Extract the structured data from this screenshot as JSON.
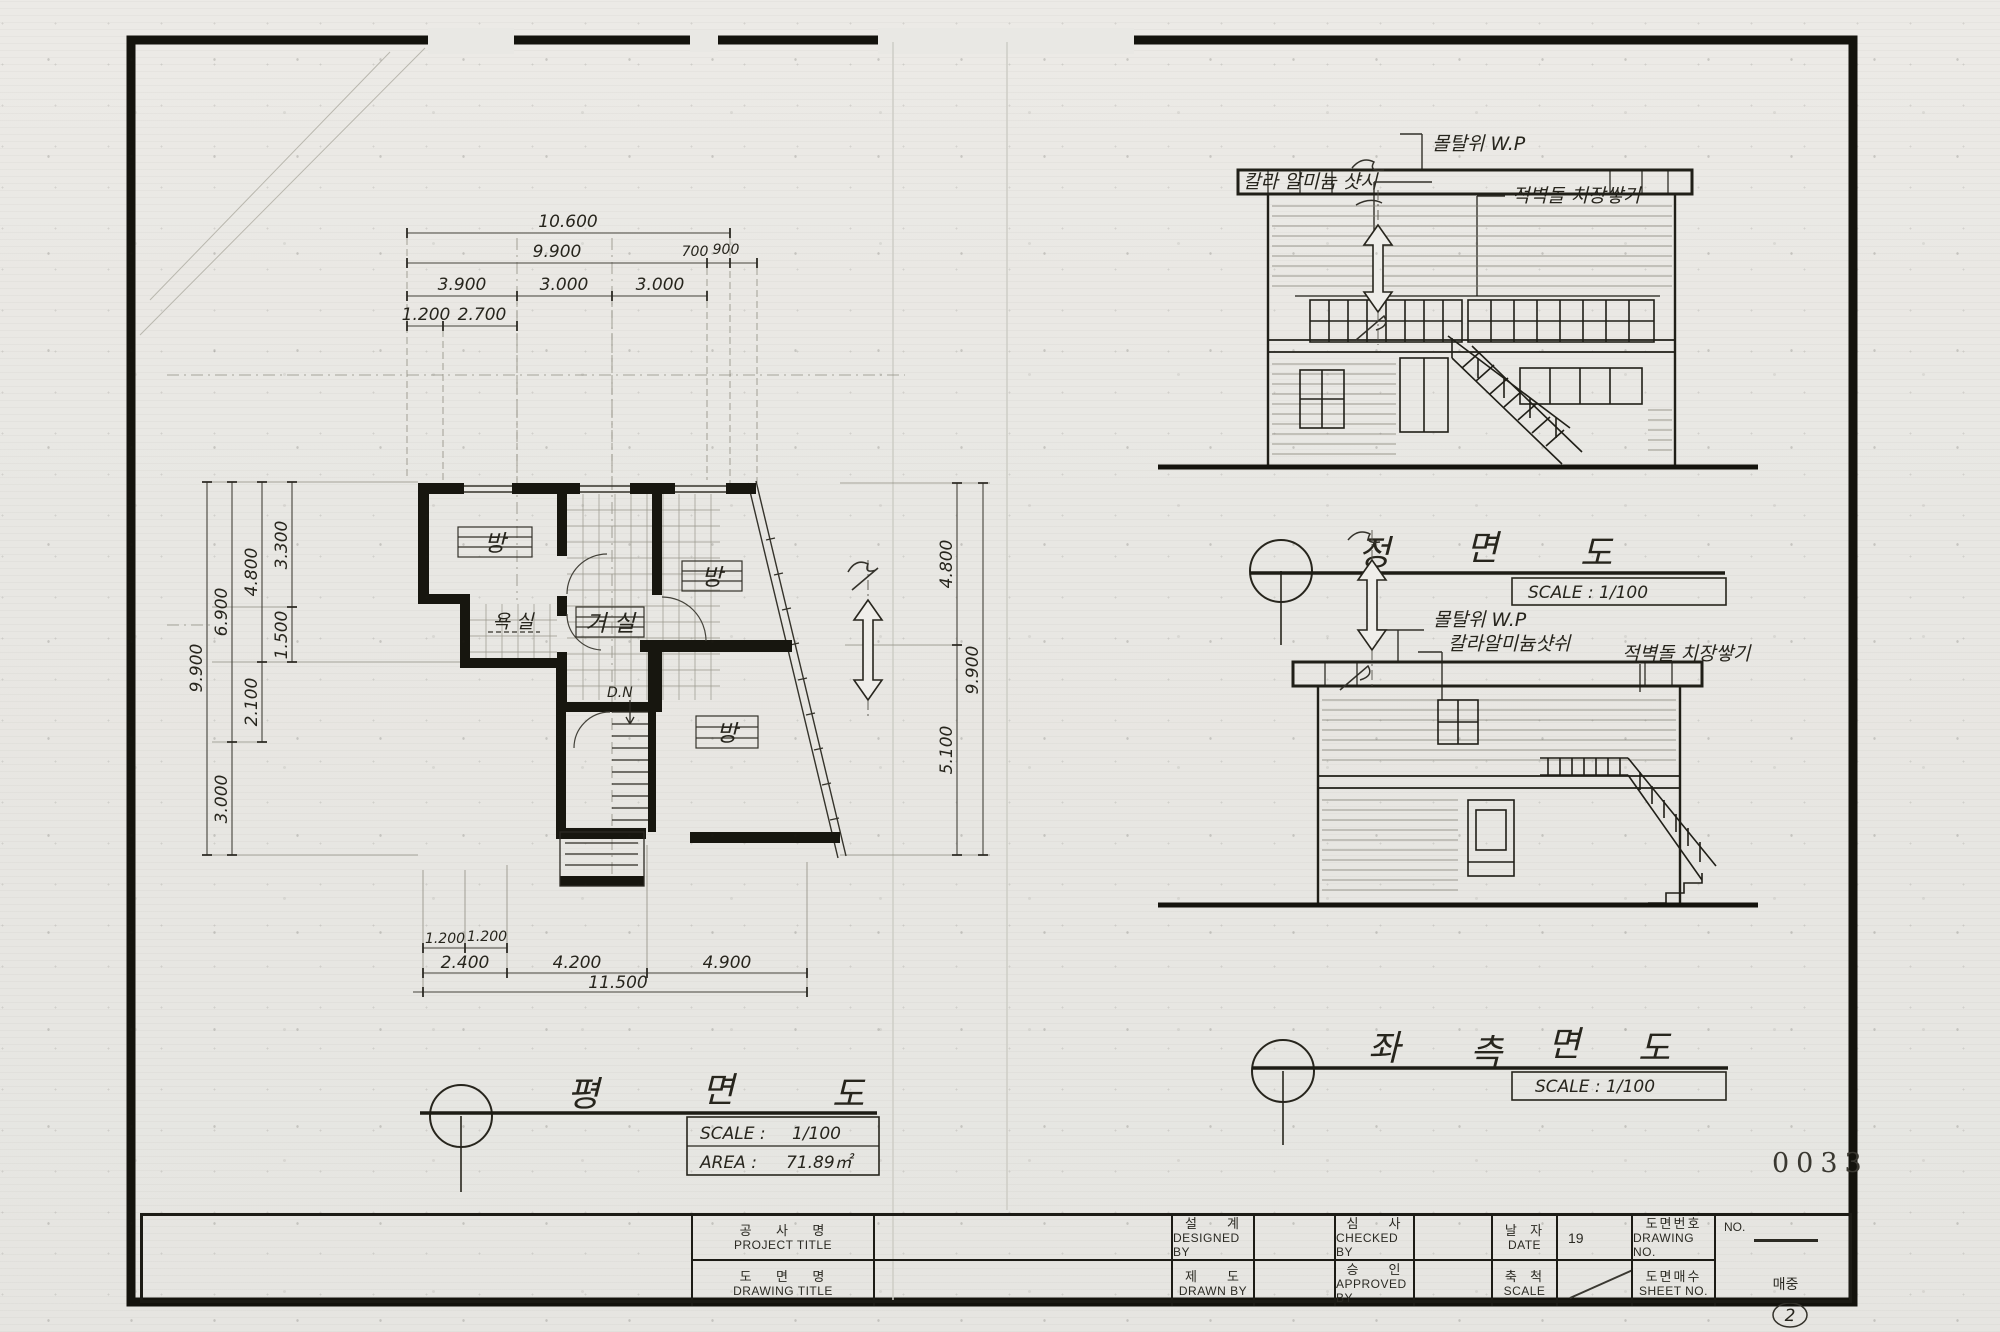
{
  "colors": {
    "paper": "#e8e7e3",
    "ink": "#201f18",
    "ink_light": "#55534a"
  },
  "stamp_number": "0033",
  "page_corner_note": "2",
  "floor_plan": {
    "title_chars": [
      "평",
      "면",
      "도"
    ],
    "scale_label": "SCALE :",
    "scale_value": "1/100",
    "area_label": "AREA :",
    "area_value": "71.89㎡",
    "rooms": {
      "room_top_left": "방",
      "room_right": "방",
      "room_bottom": "방",
      "living": "거  실",
      "bath": "욕 실",
      "stair": "D.N"
    },
    "dims_top": [
      "10.600",
      "9.900",
      "700",
      "900",
      "3.900",
      "3.000",
      "3.000",
      "1.200",
      "2.700"
    ],
    "dims_bottom": [
      "1.200",
      "1.200",
      "2.400",
      "4.200",
      "4.900",
      "11.500"
    ],
    "dims_left": [
      "9.900",
      "6.900",
      "3.000",
      "4.800",
      "2.100",
      "3.300",
      "1.500"
    ],
    "dims_right": [
      "4.800",
      "5.100",
      "9.900"
    ]
  },
  "front_elevation": {
    "title_chars": [
      "정",
      "면",
      "도"
    ],
    "scale_text": "SCALE : 1/100",
    "ann_wp": "몰탈위 W.P",
    "ann_sash": "칼라 알미늄 샷시",
    "ann_brick": "적벽돌 치장쌓기"
  },
  "side_elevation": {
    "title_chars": [
      "좌",
      "측",
      "면",
      "도"
    ],
    "scale_text": "SCALE : 1/100",
    "ann_wp": "몰탈위 W.P",
    "ann_sash": "칼라알미늄샷쉬",
    "ann_brick": "적벽돌 치장쌓기"
  },
  "title_block": {
    "project_title": {
      "ko": "공    사    명",
      "en": "PROJECT TITLE"
    },
    "drawing_title": {
      "ko": "도    면    명",
      "en": "DRAWING TITLE"
    },
    "designed_by": {
      "ko": "설     계",
      "en": "DESIGNED BY"
    },
    "drawn_by": {
      "ko": "제     도",
      "en": "DRAWN BY"
    },
    "checked_by": {
      "ko": "심     사",
      "en": "CHECKED BY"
    },
    "approved_by": {
      "ko": "승     인",
      "en": "APPROVED BY"
    },
    "date": {
      "ko": "날  자",
      "en": "DATE",
      "value": "19"
    },
    "scale": {
      "ko": "축  척",
      "en": "SCALE",
      "value": ""
    },
    "drawing_no": {
      "ko": "도면번호",
      "en": "DRAWING NO.",
      "value": "NO."
    },
    "sheet_no": {
      "ko": "도면매수",
      "en": "SHEET NO.",
      "value": "매중"
    }
  }
}
